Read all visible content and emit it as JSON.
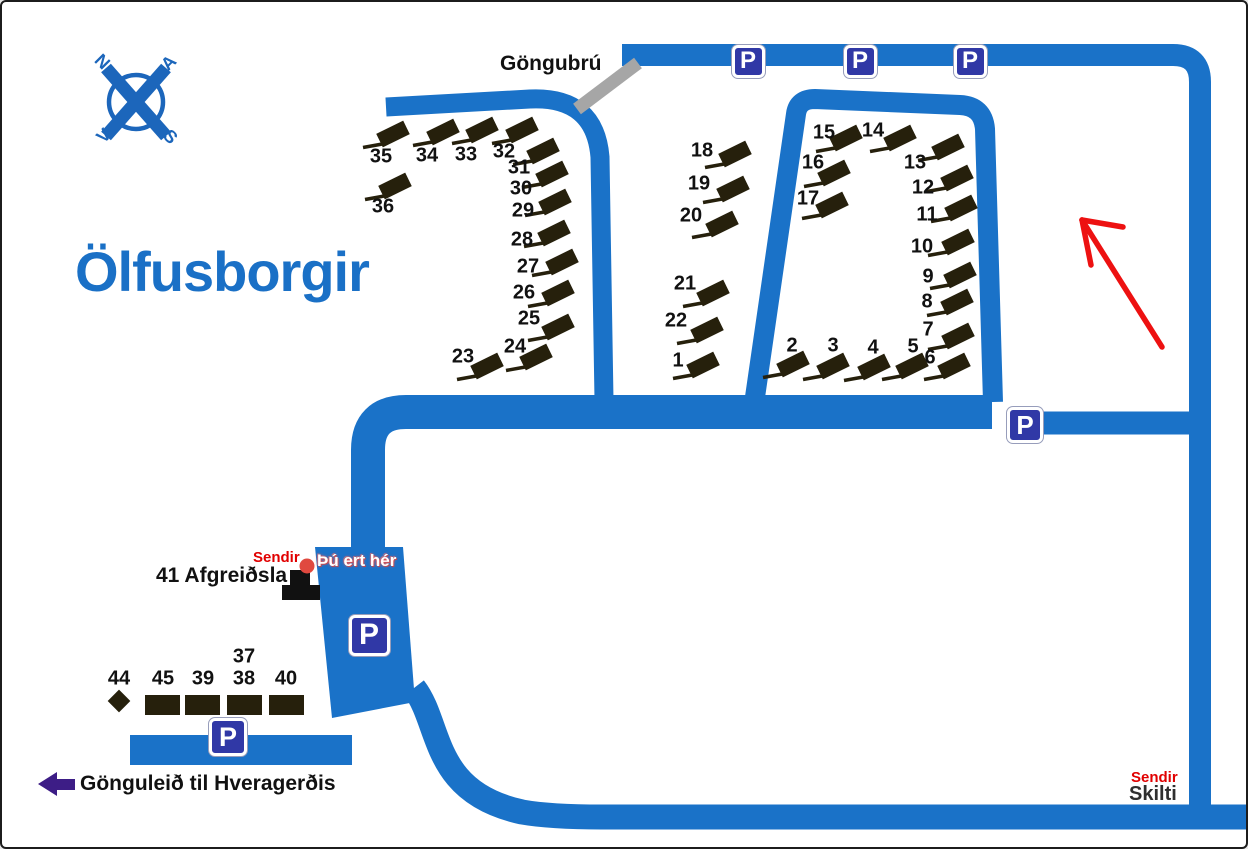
{
  "title": "Ölfusborgir",
  "bridge_label": "Göngubrú",
  "parking_letter": "P",
  "compass": {
    "north": "N",
    "east": "A",
    "south": "S",
    "west": "V"
  },
  "you_are_here": {
    "dot_label": "Sendir",
    "text": "Þú ert hér"
  },
  "reception_label": "41 Afgreiðsla",
  "walking_path_label": "Gönguleið til Hveragerðis",
  "sign_area": {
    "transmitter": "Sendir",
    "sign": "Skilti"
  },
  "colors": {
    "road": "#1a72c8",
    "parking_sign": "#3038a6",
    "cottage": "#26200c",
    "title_blue": "#1a70c6",
    "compass_blue": "#1c66bb",
    "bridge_gray": "#a6a6a6",
    "arrow_red": "#ed1111",
    "text_red": "#e10000",
    "arrow_purple": "#3d1d86"
  },
  "cabins": [
    {
      "n": "35",
      "x": 391,
      "y": 132,
      "lx": 379,
      "ly": 155
    },
    {
      "n": "34",
      "x": 441,
      "y": 130,
      "lx": 425,
      "ly": 154
    },
    {
      "n": "33",
      "x": 480,
      "y": 128,
      "lx": 464,
      "ly": 153
    },
    {
      "n": "32",
      "x": 520,
      "y": 128,
      "lx": 502,
      "ly": 150
    },
    {
      "n": "31",
      "x": 541,
      "y": 149,
      "lx": 517,
      "ly": 166
    },
    {
      "n": "30",
      "x": 550,
      "y": 172,
      "lx": 519,
      "ly": 187
    },
    {
      "n": "29",
      "x": 553,
      "y": 200,
      "lx": 521,
      "ly": 209
    },
    {
      "n": "28",
      "x": 552,
      "y": 231,
      "lx": 520,
      "ly": 238
    },
    {
      "n": "27",
      "x": 560,
      "y": 260,
      "lx": 526,
      "ly": 265
    },
    {
      "n": "26",
      "x": 556,
      "y": 291,
      "lx": 522,
      "ly": 291
    },
    {
      "n": "25",
      "x": 556,
      "y": 325,
      "lx": 527,
      "ly": 317
    },
    {
      "n": "24",
      "x": 534,
      "y": 355,
      "lx": 513,
      "ly": 345
    },
    {
      "n": "23",
      "x": 485,
      "y": 364,
      "lx": 461,
      "ly": 355
    },
    {
      "n": "36",
      "x": 393,
      "y": 184,
      "lx": 381,
      "ly": 205
    },
    {
      "n": "18",
      "x": 733,
      "y": 152,
      "lx": 700,
      "ly": 149
    },
    {
      "n": "19",
      "x": 731,
      "y": 187,
      "lx": 697,
      "ly": 182
    },
    {
      "n": "20",
      "x": 720,
      "y": 222,
      "lx": 689,
      "ly": 214
    },
    {
      "n": "21",
      "x": 711,
      "y": 291,
      "lx": 683,
      "ly": 282
    },
    {
      "n": "22",
      "x": 705,
      "y": 328,
      "lx": 674,
      "ly": 319
    },
    {
      "n": "1",
      "x": 701,
      "y": 363,
      "lx": 676,
      "ly": 359
    },
    {
      "n": "15",
      "x": 844,
      "y": 136,
      "lx": 822,
      "ly": 131
    },
    {
      "n": "14",
      "x": 898,
      "y": 136,
      "lx": 871,
      "ly": 129
    },
    {
      "n": "16",
      "x": 832,
      "y": 171,
      "lx": 811,
      "ly": 161
    },
    {
      "n": "13",
      "x": 946,
      "y": 145,
      "lx": 913,
      "ly": 161
    },
    {
      "n": "17",
      "x": 830,
      "y": 203,
      "lx": 806,
      "ly": 197
    },
    {
      "n": "12",
      "x": 955,
      "y": 176,
      "lx": 921,
      "ly": 186
    },
    {
      "n": "11",
      "x": 959,
      "y": 206,
      "lx": 925,
      "ly": 213
    },
    {
      "n": "10",
      "x": 956,
      "y": 240,
      "lx": 920,
      "ly": 245
    },
    {
      "n": "9",
      "x": 958,
      "y": 273,
      "lx": 926,
      "ly": 275
    },
    {
      "n": "8",
      "x": 955,
      "y": 300,
      "lx": 925,
      "ly": 300
    },
    {
      "n": "7",
      "x": 956,
      "y": 334,
      "lx": 926,
      "ly": 328
    },
    {
      "n": "6",
      "x": 952,
      "y": 364,
      "lx": 928,
      "ly": 356
    },
    {
      "n": "2",
      "x": 791,
      "y": 362,
      "lx": 790,
      "ly": 344
    },
    {
      "n": "3",
      "x": 831,
      "y": 364,
      "lx": 831,
      "ly": 344
    },
    {
      "n": "4",
      "x": 872,
      "y": 365,
      "lx": 871,
      "ly": 346
    },
    {
      "n": "5",
      "x": 910,
      "y": 364,
      "lx": 911,
      "ly": 345
    }
  ],
  "south_units": [
    {
      "n": "44",
      "type": "diamond",
      "x": 117,
      "y": 699
    },
    {
      "n": "45",
      "type": "flat",
      "x": 143,
      "y": 693,
      "w": 35,
      "h": 20
    },
    {
      "n": "39",
      "type": "flat",
      "x": 183,
      "y": 693,
      "w": 35,
      "h": 20
    },
    {
      "n": "38",
      "type": "flat",
      "x": 225,
      "y": 693,
      "w": 35,
      "h": 20
    },
    {
      "n": "40",
      "type": "flat",
      "x": 267,
      "y": 693,
      "w": 35,
      "h": 20
    }
  ],
  "south_labels": [
    {
      "t": "44",
      "x": 117,
      "y": 677
    },
    {
      "t": "45",
      "x": 161,
      "y": 677
    },
    {
      "t": "39",
      "x": 201,
      "y": 677
    },
    {
      "t": "37",
      "x": 242,
      "y": 655
    },
    {
      "t": "38",
      "x": 242,
      "y": 677
    },
    {
      "t": "40",
      "x": 284,
      "y": 677
    }
  ],
  "parking_signs": [
    {
      "x": 746,
      "y": 59,
      "s": 33
    },
    {
      "x": 858,
      "y": 59,
      "s": 33
    },
    {
      "x": 968,
      "y": 59,
      "s": 33
    },
    {
      "x": 1023,
      "y": 423,
      "s": 36
    },
    {
      "x": 367,
      "y": 633,
      "s": 41
    },
    {
      "x": 226,
      "y": 735,
      "s": 38
    }
  ]
}
